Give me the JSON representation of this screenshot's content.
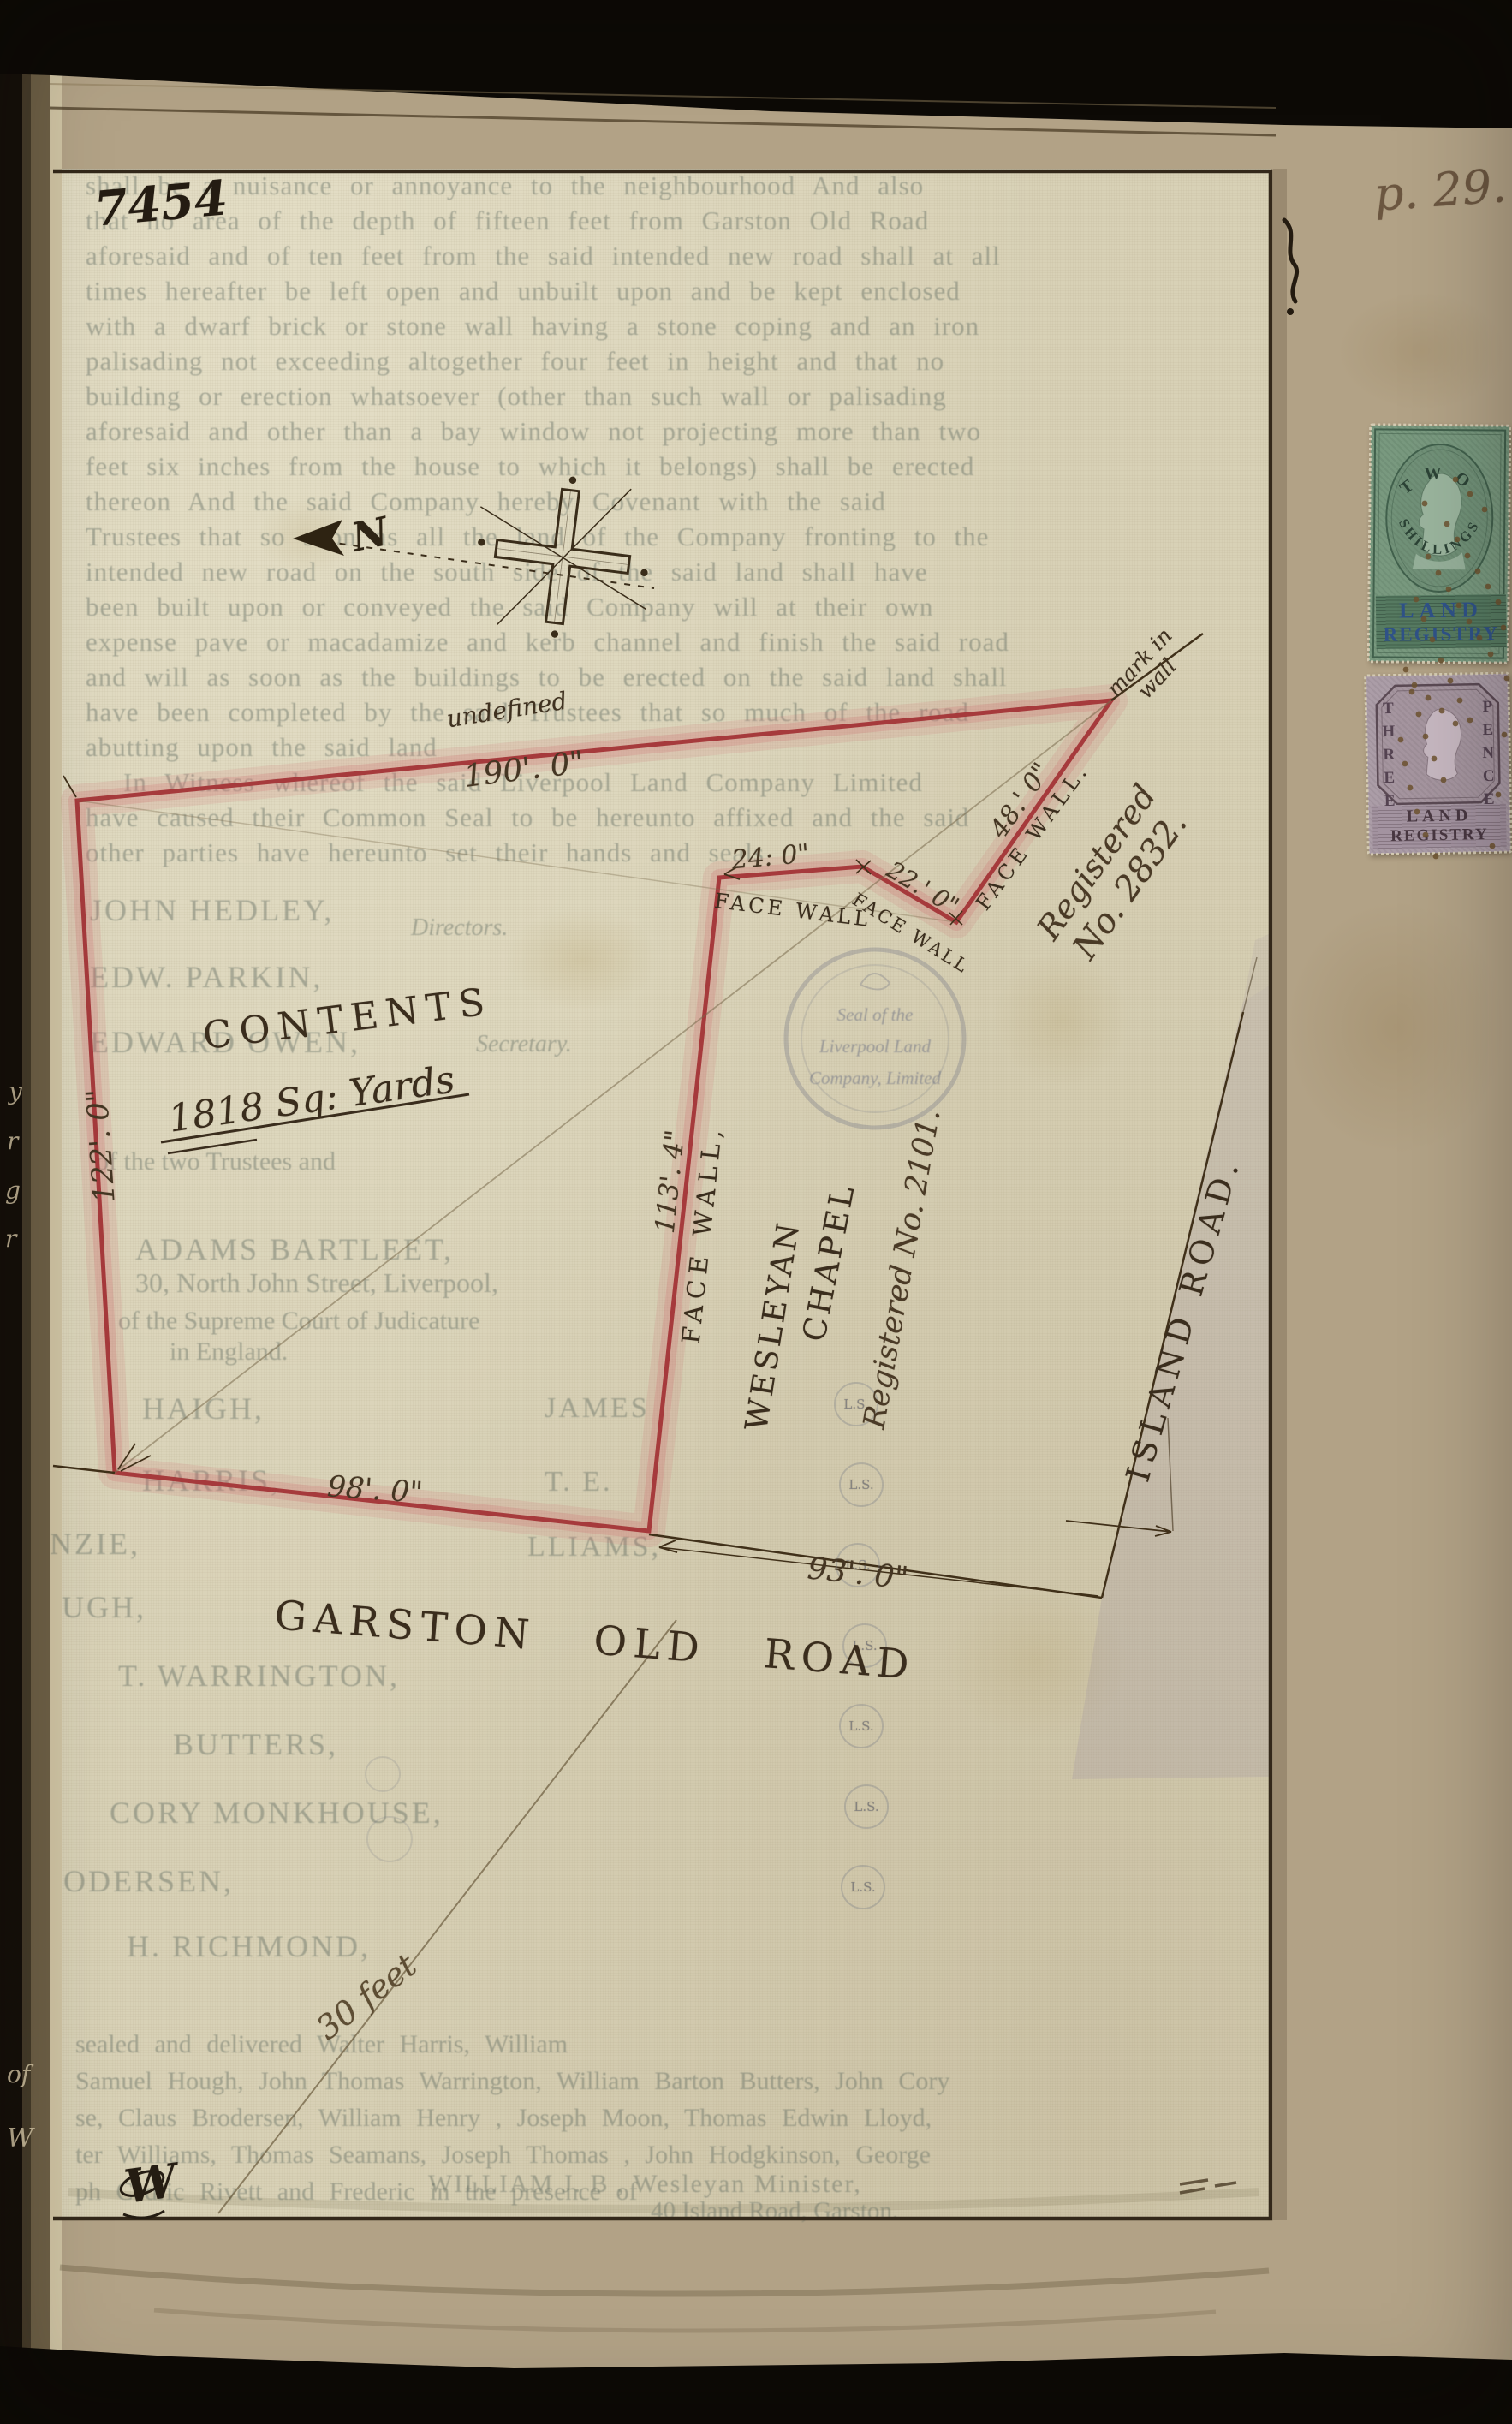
{
  "page": {
    "ref_number": "7454",
    "page_number": "p. 29."
  },
  "plan": {
    "north_label": "N",
    "boundary_note": "undefined",
    "mark_in_wall": [
      "mark in",
      "wall"
    ],
    "contents": {
      "title": "CONTENTS",
      "value": "1818  Sq: Yards"
    },
    "dims": {
      "top": "190'. 0\"",
      "left": "122'. 0\"",
      "bottom": "98'. 0\"",
      "frontage": "93'. 0\"",
      "w48": "48.' 0\"",
      "w24": "24: 0\"",
      "w22": "22.' 0\"",
      "w113": "113'. 4\"",
      "pencil_note": "30 feet"
    },
    "walls": {
      "w48": "FACE WALL.",
      "w24": "FACE WALL",
      "w22": "FACE WALL",
      "w113": "FACE WALL,"
    },
    "registered_plot": [
      "Registered",
      "No. 2832."
    ],
    "chapel": {
      "name": [
        "WESLEYAN",
        "CHAPEL"
      ],
      "registration": "Registered No. 2101."
    },
    "roads": {
      "garston": "GARSTON OLD ROAD",
      "island": "ISLAND ROAD."
    },
    "seal": [
      "Seal of the",
      "Liverpool Land",
      "Company, Limited"
    ],
    "ls": "L.S.",
    "monogram": "W"
  },
  "stamps": {
    "green": {
      "word1": "TWO",
      "word2": "SHILLINGS",
      "caption": [
        "LAND",
        "REGISTRY"
      ]
    },
    "lilac": {
      "word1": "THREE",
      "word2": "PENCE",
      "caption": [
        "LAND",
        "REGISTRY"
      ]
    }
  },
  "bleed": {
    "covenant": [
      "shall be a nuisance or annoyance to the neighbourhood  And also",
      "that no area of the depth of fifteen feet from Garston Old Road",
      "aforesaid and of ten feet from the said intended new road shall at all",
      "times hereafter be left open and unbuilt upon and be kept enclosed",
      "with a dwarf brick or stone wall having a stone coping and an iron",
      "palisading not exceeding altogether four feet in height and that no",
      "building or erection whatsoever (other than such wall or palisading",
      "aforesaid and other than a bay window not projecting more than two",
      "feet six inches from the house to which it belongs) shall be erected",
      "thereon  And the said Company hereby Covenant with the said",
      "Trustees that so soon as all the land of the Company fronting to the",
      "intended new road on the south side of the said land shall have",
      "been built upon or conveyed the said Company will at their own",
      "expense pave or macadamize and kerb channel and finish the said road",
      "and will as soon as the buildings to be erected on the said land shall",
      "have been completed by the said Trustees that so much of the road",
      "abutting upon the said land",
      "In Witness whereof the said Liverpool Land Company Limited",
      "have caused their Common Seal to be hereunto affixed and the said",
      "other parties have hereunto set their hands and seals"
    ],
    "names": [
      "JOHN HEDLEY,",
      "Directors.",
      "EDW. PARKIN,",
      "EDWARD OWEN,",
      "Secretary.",
      "of the two Trustees and",
      "ADAMS BARTLEET,",
      "30, North John Street, Liverpool,",
      "of the Supreme Court of Judicature",
      "in England.",
      "HAIGH,",
      "JAMES",
      "HARRIS,",
      "T. E.",
      "NZIE,",
      "LLIAMS,",
      "UGH,",
      "T. WARRINGTON,",
      "BUTTERS,",
      "CORY MONKHOUSE,",
      "ODERSEN,",
      "H. RICHMOND,"
    ],
    "foot": [
      "sealed and delivered              Walter Harris, William",
      "Samuel Hough, John Thomas Warrington, William Barton Butters, John Cory",
      "se, Claus Brodersen, William Henry          , Joseph Moon, Thomas Edwin Lloyd,",
      "ter Williams, Thomas Seamans, Joseph Thomas      , John Hodgkinson, George",
      "ph Cedric Rivett and Frederic           in the presence of"
    ],
    "foot_minister": "WILLIAM J. B        , Wesleyan Minister,",
    "foot_address": "40 Island Road, Garston."
  },
  "margin_fragments": [
    "y",
    "r",
    "g",
    "r",
    "of",
    "W"
  ],
  "colors": {
    "boundary_red": "#a63a3c",
    "boundary_halo": "#ce646a",
    "ink": "#3f3120",
    "pencil": "#6b5b3d",
    "paper_plan": "#d8d1b6",
    "paper_page": "#b2a286",
    "stamp_green": "#79997f",
    "stamp_green_dark": "#41604c",
    "overprint_blue": "#2f5288",
    "stamp_lilac": "#ab9da7",
    "stamp_lilac_dark": "#57454f",
    "bleed_text": "#5c6860"
  }
}
